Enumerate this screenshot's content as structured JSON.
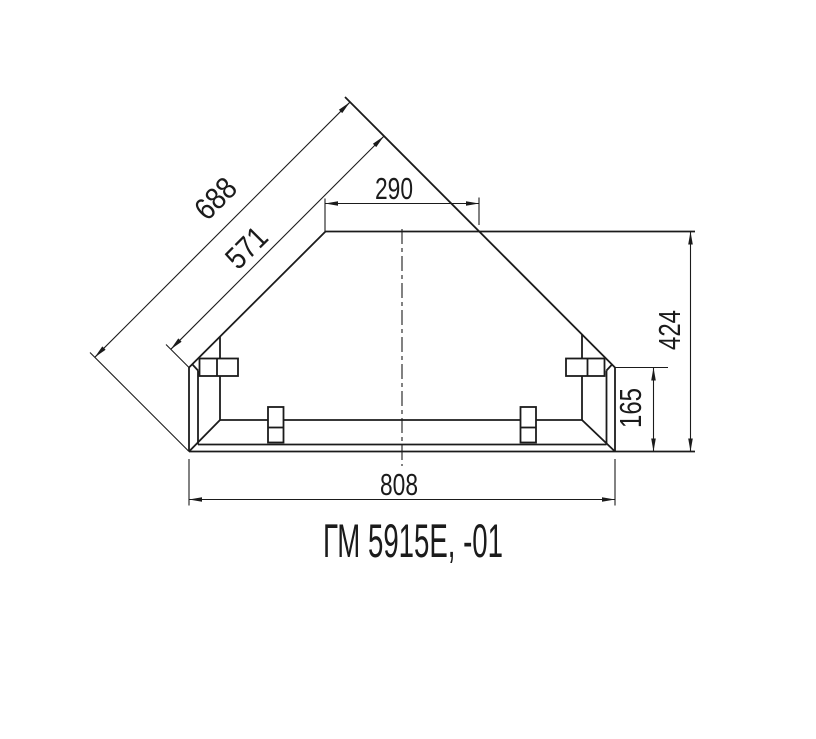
{
  "drawing": {
    "title": "ГМ 5915Е, -01",
    "colors": {
      "line": "#1b1b1b",
      "background": "#ffffff"
    },
    "dimensions": {
      "diagonal_overall": "688",
      "diagonal_edge": "571",
      "top_edge": "290",
      "overall_height": "424",
      "panel_height": "165",
      "bottom_edge": "808"
    }
  }
}
